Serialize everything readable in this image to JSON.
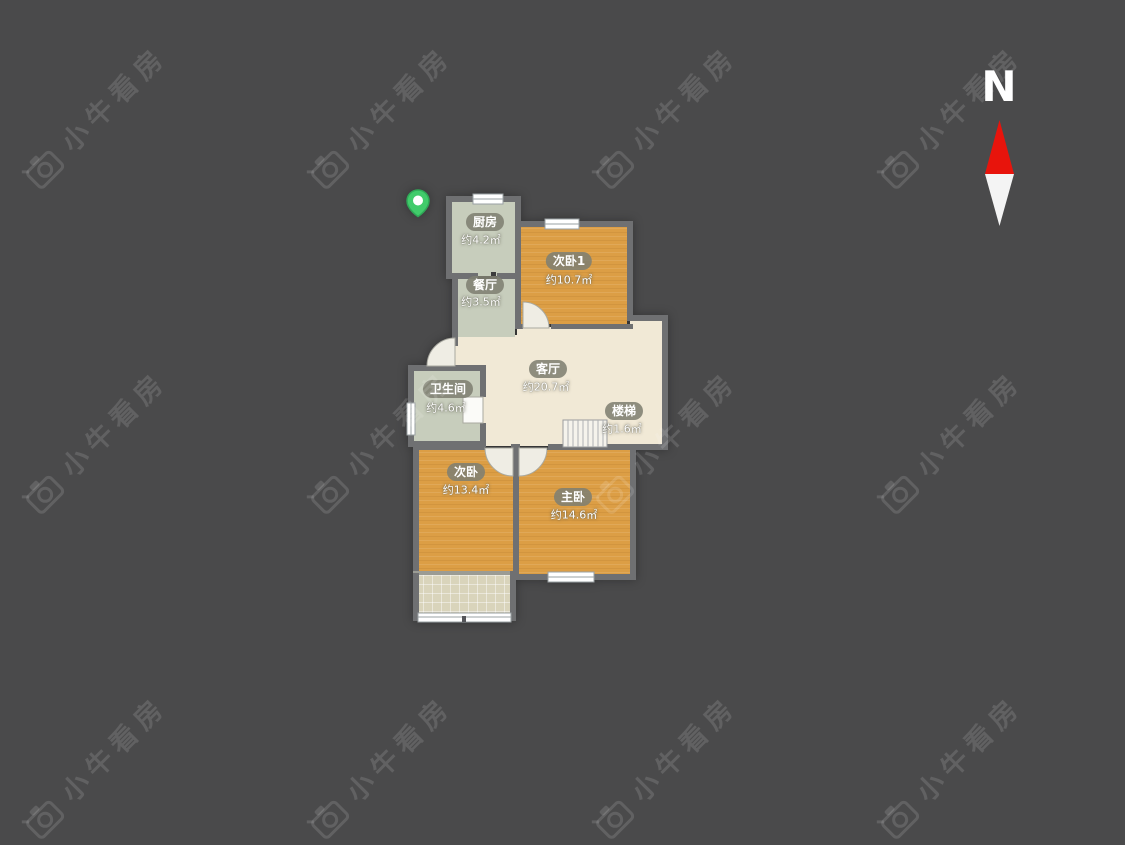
{
  "page": {
    "background_color": "#4a4a4b"
  },
  "watermark": {
    "text": "小牛看房",
    "icon": "camera-logo-icon",
    "color": "rgba(255,255,255,0.13)"
  },
  "compass": {
    "north_label": "N",
    "north_color": "#e8140c",
    "south_color": "#f4f4f4"
  },
  "floorplan": {
    "wall_color": "#6f7072",
    "floor_colors": {
      "bedroom_wood": "#dc9e45",
      "living_cream": "#f1e9d6",
      "kitchen_bath_sage": "#c7cdbc",
      "balcony_tan": "#d9d4bb"
    },
    "marker_color": "#41cb6b",
    "rooms": [
      {
        "id": "kitchen",
        "name": "厨房",
        "area": "约4.2㎡"
      },
      {
        "id": "dining",
        "name": "餐厅",
        "area": "约3.5㎡"
      },
      {
        "id": "bedroom2_1",
        "name": "次卧1",
        "area": "约10.7㎡"
      },
      {
        "id": "living",
        "name": "客厅",
        "area": "约20.7㎡"
      },
      {
        "id": "bathroom",
        "name": "卫生间",
        "area": "约4.6㎡"
      },
      {
        "id": "stairs",
        "name": "楼梯",
        "area": "约1.6㎡"
      },
      {
        "id": "bedroom2",
        "name": "次卧",
        "area": "约13.4㎡"
      },
      {
        "id": "master",
        "name": "主卧",
        "area": "约14.6㎡"
      }
    ]
  }
}
